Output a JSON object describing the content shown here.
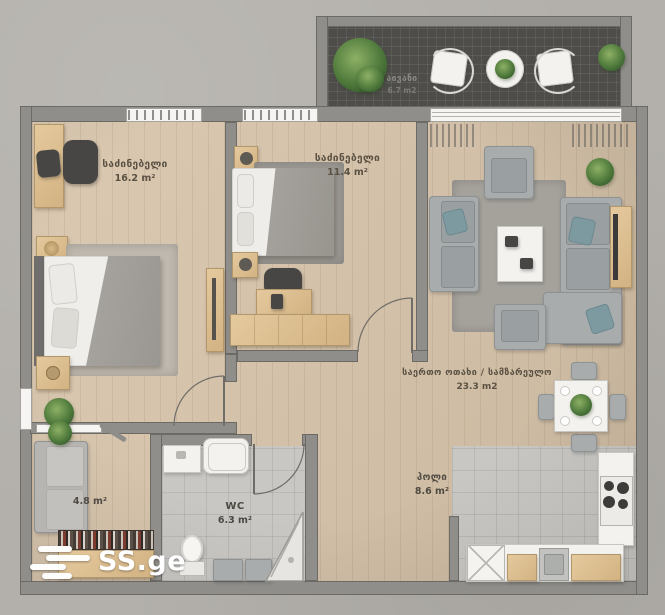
{
  "rooms": {
    "bedroom1": {
      "name": "საძინებელი",
      "area": "16.2 m²"
    },
    "bedroom2": {
      "name": "საძინებელი",
      "area": "11.4 m²"
    },
    "living": {
      "name": "საერთო ოთახი / სამზარეულო",
      "area": "23.3 m2"
    },
    "balcony": {
      "name": "აივანი",
      "area": "6.7 m2"
    },
    "entry": {
      "area": "4.8 m²"
    },
    "wc": {
      "name": "WC",
      "area": "6.3 m²"
    },
    "hall": {
      "name": "ჰოლი",
      "area": "8.6 m²"
    }
  },
  "watermark": {
    "text": "SS.ge",
    "icon": "menu-lines-logo"
  },
  "colors": {
    "background": "#b3b0ab",
    "wall": "#908e8a",
    "wood_floor": "#d7c3a9",
    "tile_floor": "#c8c7c3",
    "balcony_floor": "#4e4d4a",
    "furniture_wood": "#d9b98c",
    "sofa_gray": "#a9acac",
    "label_text": "#5a5143",
    "logo_text": "#ffffff"
  }
}
